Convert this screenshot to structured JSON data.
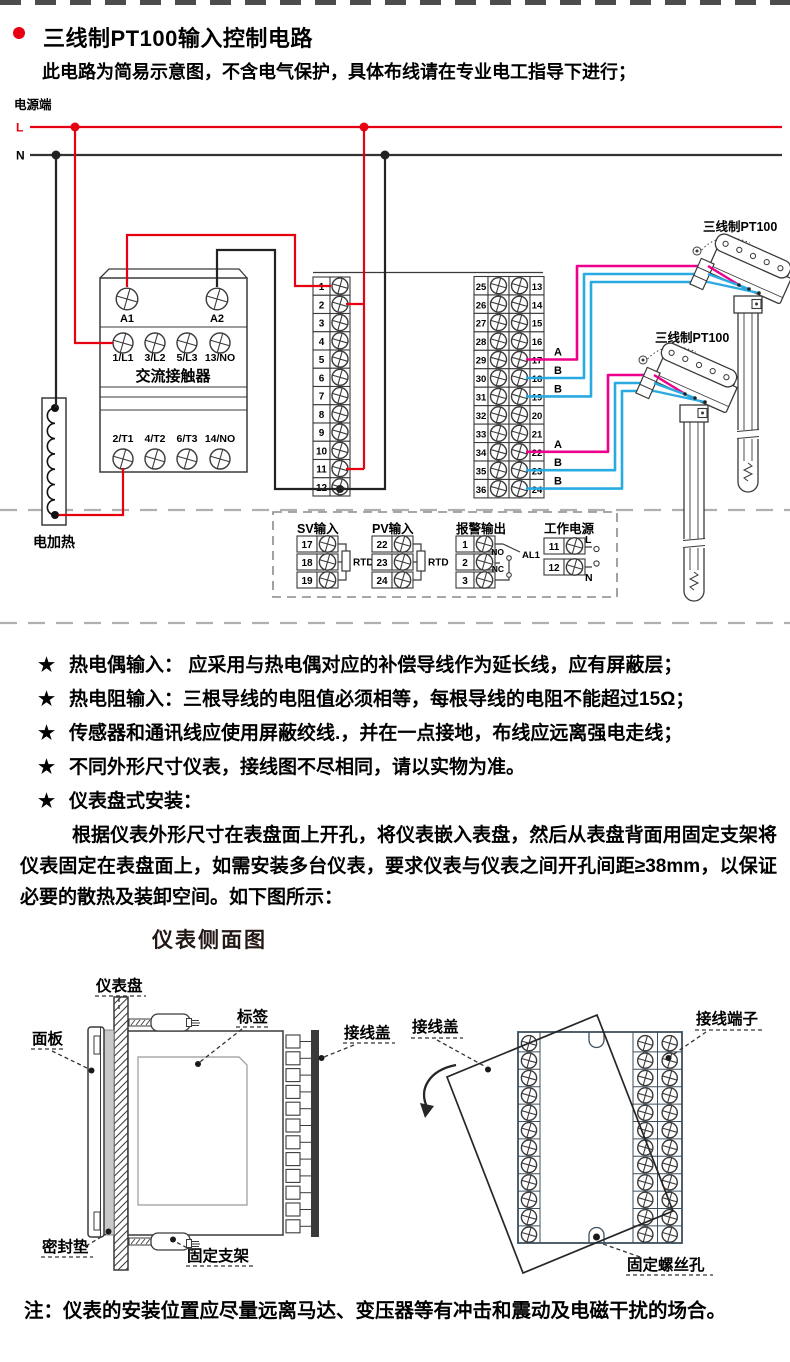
{
  "header": {
    "title": "三线制PT100输入控制电路",
    "subtitle": "此电路为简易示意图，不含电气保护，具体布线请在专业电工指导下进行；"
  },
  "colors": {
    "live_wire": "#e60012",
    "neutral_wire": "#333333",
    "wire_a": "#ec008c",
    "wire_b": "#29abe2",
    "outline": "#3a3a3a",
    "rear_outline": "#3d4f5c",
    "dash": "#b0b0b0"
  },
  "circuit": {
    "power_label": "电源端",
    "live_label": "L",
    "neutral_label": "N",
    "contactor": {
      "name": "交流接触器",
      "coil": [
        "A1",
        "A2"
      ],
      "poles_in": [
        "1/L1",
        "3/L2",
        "5/L3",
        "13/NO"
      ],
      "poles_out": [
        "2/T1",
        "4/T2",
        "6/T3",
        "14/NO"
      ]
    },
    "heater_label": "电加热",
    "left_terminals": [
      "1",
      "2",
      "3",
      "4",
      "5",
      "6",
      "7",
      "8",
      "9",
      "10",
      "11",
      "12"
    ],
    "right_terminals_outer": [
      "25",
      "26",
      "27",
      "28",
      "29",
      "30",
      "31",
      "32",
      "33",
      "34",
      "35",
      "36"
    ],
    "right_terminals_inner": [
      "13",
      "14",
      "15",
      "16",
      "17",
      "18",
      "19",
      "20",
      "21",
      "22",
      "23",
      "24"
    ],
    "sensor1_label": "三线制PT100",
    "sensor2_label": "三线制PT100",
    "wire_tags_upper": [
      "A",
      "B",
      "B"
    ],
    "wire_tags_lower": [
      "A",
      "B",
      "B"
    ],
    "io": {
      "sv": {
        "title": "SV输入",
        "terminals": [
          "17",
          "18",
          "19"
        ],
        "component": "RTD"
      },
      "pv": {
        "title": "PV输入",
        "terminals": [
          "22",
          "23",
          "24"
        ],
        "component": "RTD"
      },
      "alarm": {
        "title": "报警输出",
        "terminals": [
          "1",
          "2",
          "3"
        ],
        "no": "NO",
        "nc": "NC",
        "relay": "AL1"
      },
      "supply": {
        "title": "工作电源",
        "terminals": [
          "11",
          "12"
        ],
        "live": "L",
        "neutral": "N"
      }
    }
  },
  "notes": {
    "bullet": "★",
    "items": [
      "热电偶输入： 应采用与热电偶对应的补偿导线作为延长线，应有屏蔽层；",
      "热电阻输入：三根导线的电阻值必须相等，每根导线的电阻不能超过15Ω；",
      "传感器和通讯线应使用屏蔽绞线.，并在一点接地，布线应远离强电走线；",
      "不同外形尺寸仪表，接线图不尽相同，请以实物为准。",
      "仪表盘式安装："
    ]
  },
  "install": {
    "paragraph": "根据仪表外形尺寸在表盘面上开孔，将仪表嵌入表盘，然后从表盘背面用固定支架将仪表固定在表盘面上，如需安装多台仪表，要求仪表与仪表之间开孔间距≥38mm，以保证必要的散热及装卸空间。如下图所示：",
    "side_title": "仪表侧面图",
    "labels": {
      "panel_board": "仪表盘",
      "front_panel": "面板",
      "sticker": "标签",
      "wire_cover_side": "接线盖",
      "gasket": "密封垫",
      "bracket": "固定支架",
      "wire_cover_rear": "接线盖",
      "terminals": "接线端子",
      "screw_hole": "固定螺丝孔"
    }
  },
  "footer_note": "注：仪表的安装位置应尽量远离马达、变压器等有冲击和震动及电磁干扰的场合。"
}
